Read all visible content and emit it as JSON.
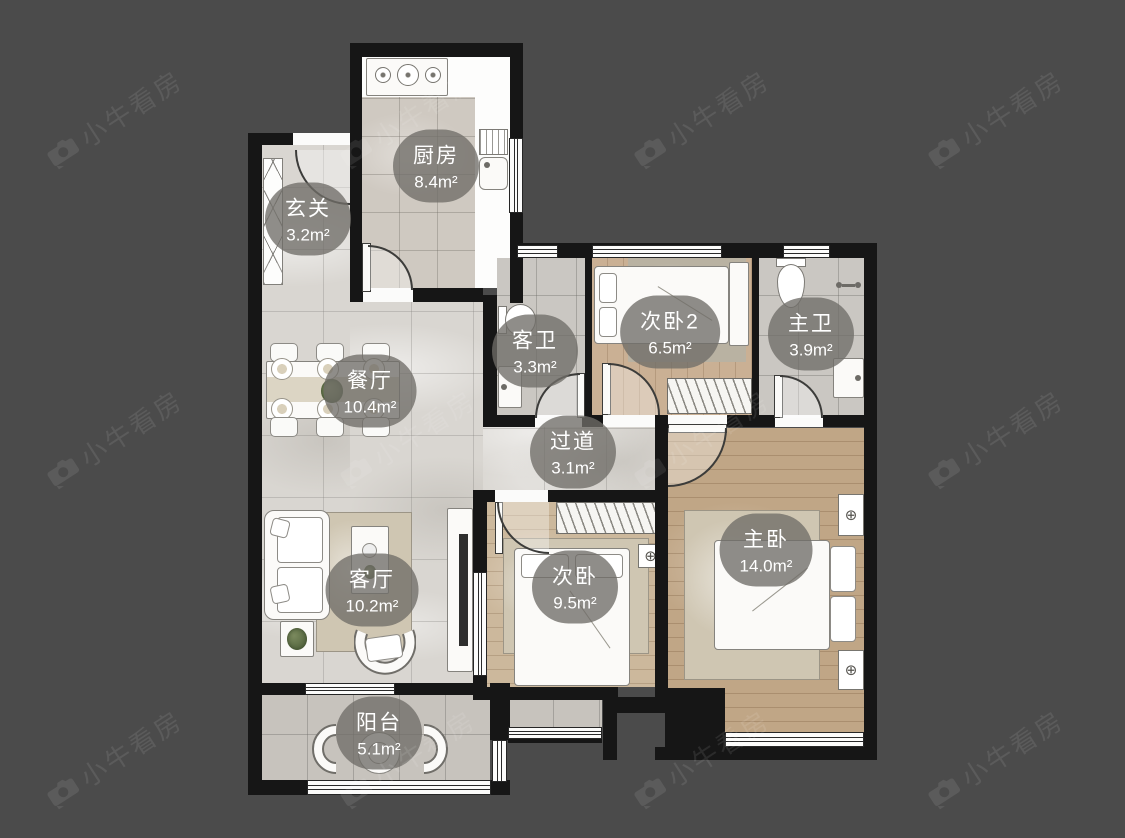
{
  "watermark": {
    "text": "小牛看房"
  },
  "icons": {
    "ac": "⊕"
  },
  "rooms": [
    {
      "id": "kitchen",
      "name": "厨房",
      "area": "8.4m²"
    },
    {
      "id": "entry",
      "name": "玄关",
      "area": "3.2m²"
    },
    {
      "id": "dining",
      "name": "餐厅",
      "area": "10.4m²"
    },
    {
      "id": "guest-bath",
      "name": "客卫",
      "area": "3.3m²"
    },
    {
      "id": "bedroom-2",
      "name": "次卧2",
      "area": "6.5m²"
    },
    {
      "id": "master-bath",
      "name": "主卫",
      "area": "3.9m²"
    },
    {
      "id": "hallway",
      "name": "过道",
      "area": "3.1m²"
    },
    {
      "id": "living",
      "name": "客厅",
      "area": "10.2m²"
    },
    {
      "id": "bedroom",
      "name": "次卧",
      "area": "9.5m²"
    },
    {
      "id": "master-bedroom",
      "name": "主卧",
      "area": "14.0m²"
    },
    {
      "id": "balcony",
      "name": "阳台",
      "area": "5.1m²"
    }
  ]
}
